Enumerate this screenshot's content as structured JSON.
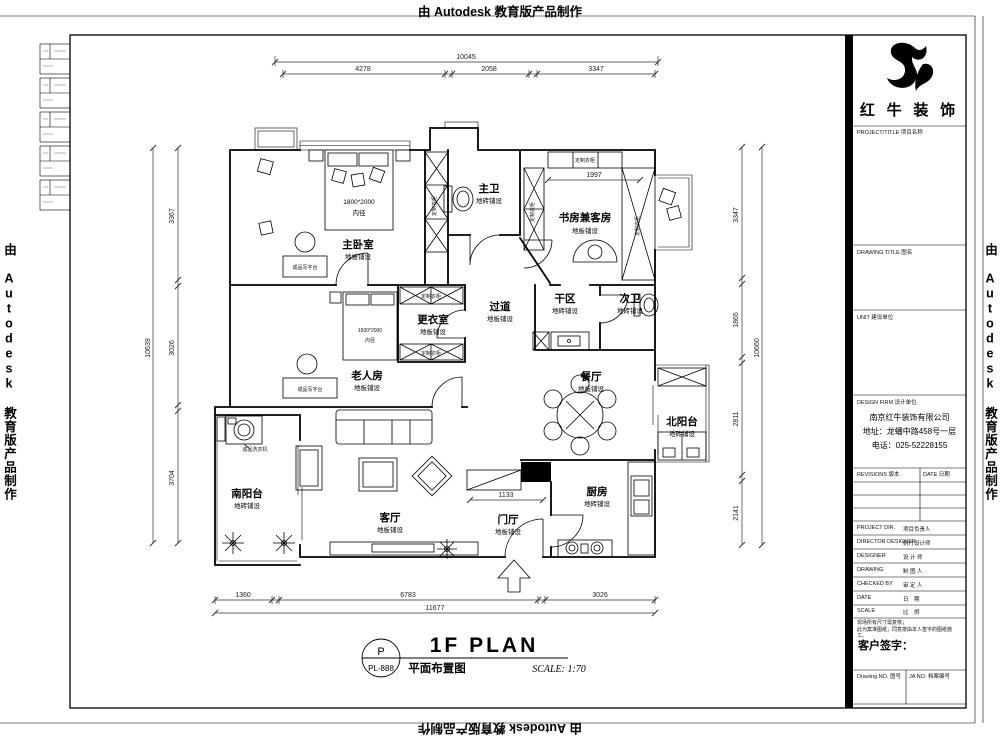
{
  "watermark": "由 Autodesk 教育版产品制作",
  "sheet": {
    "stamp_letter": "P",
    "stamp_number": "PL-888",
    "title_en": "1F PLAN",
    "title_zh": "平面布置图",
    "scale_note": "SCALE: 1:70"
  },
  "title_block": {
    "brand_name": "红 牛 装 饰",
    "project_label": "PROJECT/TITLE 项目名称",
    "drawing_title_label": "DRAWING TITLE 图名",
    "unit_label": "UNIT 建设单位",
    "design_firm_label": "DESIGN FIRM 设计单位",
    "company_name": "南京红牛装饰有限公司",
    "company_address": "地址：龙蟠中路458号一层",
    "company_phone": "电话：025-52228155",
    "revisions_label": "REVISIONS 版本",
    "date_col_label": "DATE 日期",
    "staff_rows": [
      {
        "en": "PROJECT DIR.",
        "zh": "项目负责人"
      },
      {
        "en": "DIRECTOR DESIGNER",
        "zh": "执行设计师"
      },
      {
        "en": "DESIGNER",
        "zh": "设 计 师"
      },
      {
        "en": "DRAWING",
        "zh": "制 图 人"
      },
      {
        "en": "CHECKED BY",
        "zh": "审 定 人"
      },
      {
        "en": "DATE",
        "zh": "日　期"
      },
      {
        "en": "SCALE",
        "zh": "比　例"
      }
    ],
    "disclaimer_line1": "现场所有尺寸需复核；",
    "disclaimer_line2": "此为案准图纸，同意按由本人签字的图纸施工。",
    "client_sign_label": "客户签字：",
    "drawing_no_label": "Drawing NO. 图号",
    "file_no_label": "JA NO. 档案编号"
  },
  "plan": {
    "rooms": [
      {
        "name": "主卧室",
        "finish": "地板铺设"
      },
      {
        "name": "主卫",
        "finish": "地砖铺设"
      },
      {
        "name": "书房兼客房",
        "finish": "地板铺设"
      },
      {
        "name": "次卫",
        "finish": "地砖铺设"
      },
      {
        "name": "干区",
        "finish": "地砖铺设"
      },
      {
        "name": "过道",
        "finish": "地板铺设"
      },
      {
        "name": "更衣室",
        "finish": "地板铺设"
      },
      {
        "name": "老人房",
        "finish": "地板铺设"
      },
      {
        "name": "餐厅",
        "finish": "地板铺设"
      },
      {
        "name": "北阳台",
        "finish": "地砖铺设"
      },
      {
        "name": "南阳台",
        "finish": "地砖铺设"
      },
      {
        "name": "客厅",
        "finish": "地板铺设"
      },
      {
        "name": "门厅",
        "finish": "地板铺设"
      },
      {
        "name": "厨房",
        "finish": "地砖铺设"
      }
    ],
    "bed_master": {
      "size": "1800*2000",
      "note": "内径"
    },
    "bed_elder": {
      "size": "1500*2000",
      "note": "内径"
    },
    "labels": {
      "wardrobe": "定制衣柜",
      "desk": "成品写字台",
      "washer": "成品洗衣机"
    }
  },
  "dims": {
    "top": {
      "overall": "10045",
      "segments": [
        "4278",
        "2058",
        "3347"
      ]
    },
    "bottom": {
      "overall": "11677",
      "segments": [
        "1360",
        "6783",
        "3026"
      ]
    },
    "left": {
      "overall": "10639",
      "segments": [
        "3367",
        "3026",
        "3704"
      ]
    },
    "right": {
      "overall": "10660",
      "segments": [
        "3347",
        "1865",
        "2811",
        "2141"
      ]
    },
    "inner": {
      "study_width": "1997",
      "foyer_width": "1133"
    }
  }
}
